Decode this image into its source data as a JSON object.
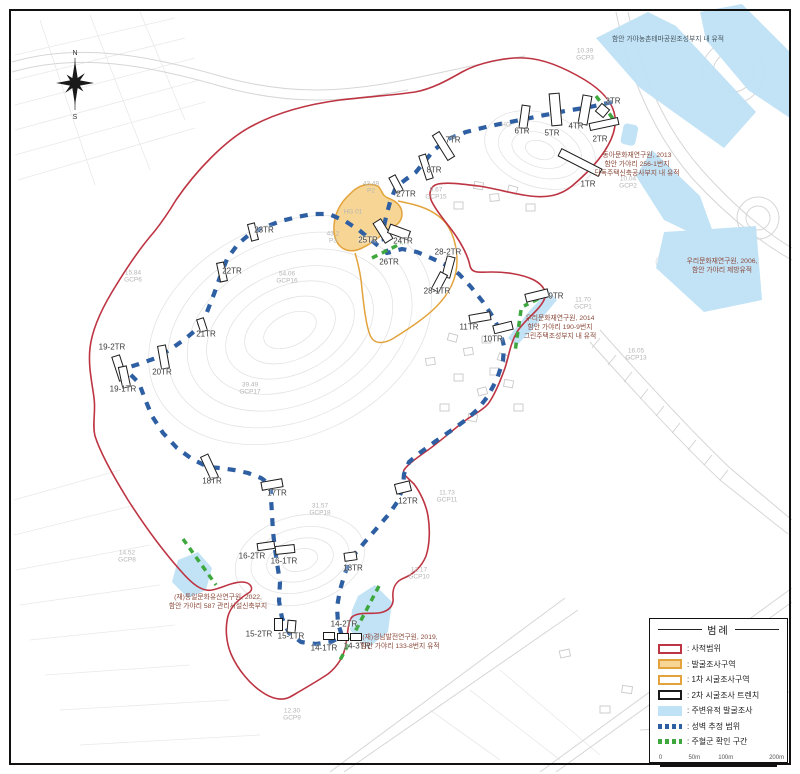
{
  "colors": {
    "site_boundary_red": "#bd3442",
    "excavation_fill": "#f7d695",
    "excavation_border": "#e3a33c",
    "trench_outline": "#1b1b1b",
    "nearby_site_blue": "#bfe2f6",
    "wall_line_blue": "#2e5fa3",
    "posthole_green": "#3ea83e"
  },
  "compass": {
    "north_label": "N",
    "south_label": "S"
  },
  "legend": {
    "title": "범례",
    "items": [
      {
        "type": "sw-red",
        "label": ": 사적범위"
      },
      {
        "type": "sw-orange-fill",
        "label": ": 발굴조사구역"
      },
      {
        "type": "sw-orange",
        "label": ": 1차 시굴조사구역"
      },
      {
        "type": "sw-black",
        "label": ": 2차 시굴조사 트렌치"
      },
      {
        "type": "sw-blue",
        "label": ": 주변유적 발굴조사"
      },
      {
        "type": "sw-bluedash",
        "label": ": 성벽 추정 범위"
      },
      {
        "type": "sw-greendash",
        "label": ": 주혈군 확인 구간"
      }
    ],
    "scale_labels": [
      {
        "t": "0",
        "p": 2
      },
      {
        "t": "50m",
        "p": 30
      },
      {
        "t": "100m",
        "p": 56
      },
      {
        "t": "200m",
        "p": 98
      }
    ]
  },
  "map": {
    "trench_rects": [
      {
        "x": 580,
        "y": 162,
        "w": 46,
        "h": 9,
        "rot": 27
      },
      {
        "x": 604,
        "y": 124,
        "w": 30,
        "h": 8,
        "rot": -12
      },
      {
        "x": 602,
        "y": 110,
        "w": 11,
        "h": 11,
        "rot": 40
      },
      {
        "x": 585,
        "y": 110,
        "w": 10,
        "h": 30,
        "rot": 10
      },
      {
        "x": 555,
        "y": 109,
        "w": 11,
        "h": 33,
        "rot": -5
      },
      {
        "x": 524,
        "y": 117,
        "w": 9,
        "h": 24,
        "rot": 8
      },
      {
        "x": 443,
        "y": 146,
        "w": 9,
        "h": 30,
        "rot": -32
      },
      {
        "x": 426,
        "y": 167,
        "w": 8,
        "h": 26,
        "rot": -18
      },
      {
        "x": 396,
        "y": 184,
        "w": 8,
        "h": 18,
        "rot": -28
      },
      {
        "x": 383,
        "y": 231,
        "w": 10,
        "h": 24,
        "rot": -32
      },
      {
        "x": 399,
        "y": 232,
        "w": 22,
        "h": 10,
        "rot": 20
      },
      {
        "x": 448,
        "y": 267,
        "w": 9,
        "h": 22,
        "rot": 15
      },
      {
        "x": 439,
        "y": 282,
        "w": 9,
        "h": 20,
        "rot": 28
      },
      {
        "x": 537,
        "y": 295,
        "w": 24,
        "h": 9,
        "rot": -14
      },
      {
        "x": 480,
        "y": 317,
        "w": 22,
        "h": 9,
        "rot": -10
      },
      {
        "x": 503,
        "y": 327,
        "w": 20,
        "h": 9,
        "rot": -14
      },
      {
        "x": 403,
        "y": 487,
        "w": 16,
        "h": 11,
        "rot": -14
      },
      {
        "x": 350,
        "y": 556,
        "w": 13,
        "h": 9,
        "rot": -8
      },
      {
        "x": 329,
        "y": 636,
        "w": 12,
        "h": 8,
        "rot": 0
      },
      {
        "x": 343,
        "y": 637,
        "w": 12,
        "h": 8,
        "rot": 0
      },
      {
        "x": 356,
        "y": 637,
        "w": 12,
        "h": 8,
        "rot": 0
      },
      {
        "x": 278,
        "y": 624,
        "w": 9,
        "h": 13,
        "rot": 0
      },
      {
        "x": 291,
        "y": 626,
        "w": 9,
        "h": 13,
        "rot": 5
      },
      {
        "x": 266,
        "y": 546,
        "w": 18,
        "h": 8,
        "rot": -8
      },
      {
        "x": 285,
        "y": 549,
        "w": 20,
        "h": 9,
        "rot": -6
      },
      {
        "x": 272,
        "y": 484,
        "w": 22,
        "h": 9,
        "rot": -10
      },
      {
        "x": 209,
        "y": 467,
        "w": 9,
        "h": 26,
        "rot": -25
      },
      {
        "x": 119,
        "y": 368,
        "w": 9,
        "h": 26,
        "rot": -18
      },
      {
        "x": 124,
        "y": 377,
        "w": 9,
        "h": 22,
        "rot": -12
      },
      {
        "x": 163,
        "y": 357,
        "w": 9,
        "h": 24,
        "rot": -10
      },
      {
        "x": 202,
        "y": 325,
        "w": 8,
        "h": 14,
        "rot": -18
      },
      {
        "x": 222,
        "y": 272,
        "w": 8,
        "h": 20,
        "rot": -12
      },
      {
        "x": 253,
        "y": 232,
        "w": 8,
        "h": 18,
        "rot": -14
      }
    ],
    "trench_labels": [
      {
        "text": "1TR",
        "x": 588,
        "y": 184
      },
      {
        "text": "2TR",
        "x": 600,
        "y": 139
      },
      {
        "text": "3TR",
        "x": 613,
        "y": 101
      },
      {
        "text": "4TR",
        "x": 576,
        "y": 126
      },
      {
        "text": "5TR",
        "x": 552,
        "y": 133
      },
      {
        "text": "6TR",
        "x": 522,
        "y": 131
      },
      {
        "text": "7TR",
        "x": 453,
        "y": 140
      },
      {
        "text": "8TR",
        "x": 434,
        "y": 170
      },
      {
        "text": "27TR",
        "x": 406,
        "y": 194
      },
      {
        "text": "25TR",
        "x": 368,
        "y": 240
      },
      {
        "text": "24TR",
        "x": 403,
        "y": 241
      },
      {
        "text": "26TR",
        "x": 389,
        "y": 262
      },
      {
        "text": "28-2TR",
        "x": 448,
        "y": 252
      },
      {
        "text": "28-1TR",
        "x": 437,
        "y": 291
      },
      {
        "text": "9TR",
        "x": 556,
        "y": 296
      },
      {
        "text": "11TR",
        "x": 469,
        "y": 327
      },
      {
        "text": "10TR",
        "x": 493,
        "y": 339
      },
      {
        "text": "12TR",
        "x": 408,
        "y": 501
      },
      {
        "text": "13TR",
        "x": 353,
        "y": 568
      },
      {
        "text": "14-2TR",
        "x": 344,
        "y": 624
      },
      {
        "text": "14-1TR",
        "x": 324,
        "y": 648
      },
      {
        "text": "14-3TR",
        "x": 357,
        "y": 646
      },
      {
        "text": "15-2TR",
        "x": 259,
        "y": 634
      },
      {
        "text": "15-1TR",
        "x": 291,
        "y": 636
      },
      {
        "text": "16-2TR",
        "x": 252,
        "y": 556
      },
      {
        "text": "16-1TR",
        "x": 284,
        "y": 561
      },
      {
        "text": "17TR",
        "x": 277,
        "y": 493
      },
      {
        "text": "18TR",
        "x": 212,
        "y": 481
      },
      {
        "text": "19-2TR",
        "x": 112,
        "y": 347
      },
      {
        "text": "19-1TR",
        "x": 123,
        "y": 389
      },
      {
        "text": "20TR",
        "x": 162,
        "y": 372
      },
      {
        "text": "21TR",
        "x": 206,
        "y": 334
      },
      {
        "text": "22TR",
        "x": 232,
        "y": 271
      },
      {
        "text": "23TR",
        "x": 264,
        "y": 230
      }
    ],
    "gcp_markers": [
      {
        "v": "10.39",
        "id": "GCP3",
        "x": 585,
        "y": 55
      },
      {
        "v": "10.04",
        "id": "GCP2",
        "x": 628,
        "y": 183
      },
      {
        "v": "9.67",
        "id": "GCP15",
        "x": 436,
        "y": 194
      },
      {
        "v": "43.49",
        "id": "P2",
        "x": 371,
        "y": 188
      },
      {
        "v": "43.2",
        "id": "P3",
        "x": 333,
        "y": 238
      },
      {
        "v": "54.06",
        "id": "GCP16",
        "x": 287,
        "y": 278
      },
      {
        "v": "15.84",
        "id": "GCP6",
        "x": 133,
        "y": 277
      },
      {
        "v": "39.49",
        "id": "GCP17",
        "x": 250,
        "y": 389
      },
      {
        "v": "31.57",
        "id": "GCP18",
        "x": 320,
        "y": 510
      },
      {
        "v": "14.52",
        "id": "GCP8",
        "x": 127,
        "y": 557
      },
      {
        "v": "11.73",
        "id": "GCP11",
        "x": 447,
        "y": 497
      },
      {
        "v": "11.70",
        "id": "GCP1",
        "x": 583,
        "y": 304
      },
      {
        "v": "16.05",
        "id": "GCP13",
        "x": 636,
        "y": 355
      },
      {
        "v": "12.17",
        "id": "GCP10",
        "x": 419,
        "y": 574
      },
      {
        "v": "12.30",
        "id": "GCP9",
        "x": 292,
        "y": 715
      }
    ],
    "misc_labels": [
      {
        "t": "HG",
        "x": 506,
        "y": 125
      },
      {
        "t": "HG 01",
        "x": 353,
        "y": 212
      }
    ],
    "annotations": [
      {
        "variant": "dark",
        "x": 668,
        "y": 36,
        "lines": [
          "함안 가야농촌테마공원조성부지 내 유적"
        ]
      },
      {
        "variant": "",
        "x": 637,
        "y": 152,
        "lines": [
          "동아문화재연구원, 2013",
          "함안 가야리 256-1번지",
          "단독주택신축공사부지 내 유적"
        ]
      },
      {
        "variant": "",
        "x": 722,
        "y": 258,
        "lines": [
          "우리문화재연구원, 2006,",
          "함안 가야리 제방유적"
        ]
      },
      {
        "variant": "",
        "x": 560,
        "y": 315,
        "lines": [
          "우리문화재연구원, 2014",
          "함안 가야리 190-9번지",
          "그린주택조성부지 내 유적"
        ]
      },
      {
        "variant": "",
        "x": 218,
        "y": 594,
        "lines": [
          "(재)통일문화유산연구원, 2022,",
          "함안 가야리 587 관리시설신축부지"
        ]
      },
      {
        "variant": "",
        "x": 400,
        "y": 634,
        "lines": [
          "(재)경남발전연구원, 2019,",
          "함안 가야리 133-8번지 유적"
        ]
      }
    ]
  }
}
